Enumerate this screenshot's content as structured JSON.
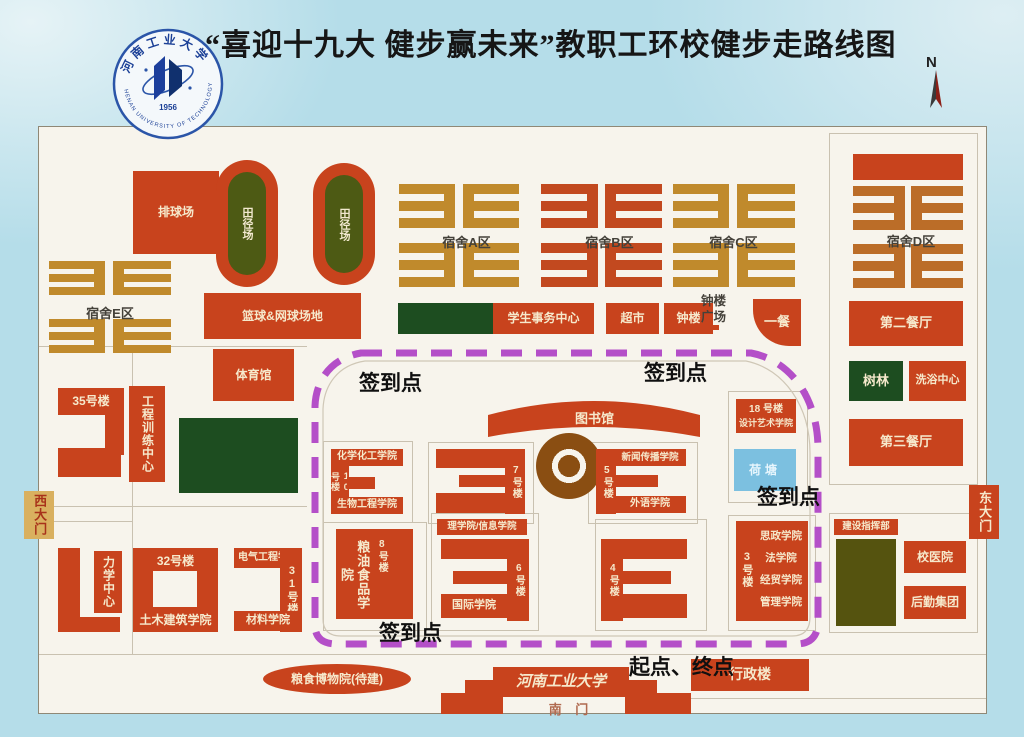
{
  "title": "“喜迎十九大 健步赢未来”教职工环校健步走路线图",
  "logo": {
    "name_cn": "河南工业大学",
    "name_en": "HENAN UNIVERSITY OF TECHNOLOGY",
    "year": "1956"
  },
  "compass": {
    "north": "N"
  },
  "colors": {
    "background": "#b5dde9",
    "paper": "#f7f4ec",
    "building": "#c8431d",
    "dorm_gold": "#c08a2c",
    "dorm_red": "#c2491f",
    "dark_green": "#1d4d20",
    "olive_green": "#55530f",
    "pond_blue": "#7cc0e0",
    "route": "#b44fc8"
  },
  "route": {
    "checkpoint": "签到点",
    "start_end": "起点、终点"
  },
  "labels": {
    "paiqiu": "排球场",
    "tianjing": "田径场",
    "lanqiu": "篮球&网球场地",
    "tiyuguan": "体育馆",
    "sushe_a": "宿舍A区",
    "sushe_b": "宿舍B区",
    "sushe_c": "宿舍C区",
    "sushe_d": "宿舍D区",
    "sushe_e": "宿舍E区",
    "xuesheng": "学生事务中心",
    "chaoshi": "超市",
    "zhonglou": "钟楼",
    "zhonglou_gc": "钟楼广场",
    "yican": "一餐",
    "lou35": "35号楼",
    "gongxun": "工程训练中心",
    "ximen": "西大门",
    "dongmen": "东大门",
    "lixue": "力学中心",
    "lou32": "32号楼",
    "tumu": "土木建筑学院",
    "dianqi": "电气工程学院",
    "lou31": "31号楼",
    "cailiao": "材料学院",
    "tushuguan": "图书馆",
    "huaxue": "化学化工学院",
    "lou10": "10号楼",
    "shengwu": "生物工程学院",
    "lou7": "7号楼",
    "xinwen": "新闻传播学院",
    "lou5": "5号楼",
    "waiyu": "外语学院",
    "lixin": "理学院/信息学院",
    "lou6": "6号楼",
    "guoji": "国际学院",
    "lou8": "8号楼",
    "liangyou": "粮油食品学院",
    "lou4": "4号楼",
    "lou3": "3号楼",
    "sizheng": "思政学院",
    "faxue": "法学院",
    "jingmao": "经贸学院",
    "guanli": "管理学院",
    "lou18": "18 号楼",
    "sheji": "设计艺术学院",
    "hetang": "荷塘",
    "dier": "第二餐厅",
    "shulin": "树林",
    "xiyu": "洗浴中心",
    "disan": "第三餐厅",
    "jianzhi": "建设指挥部",
    "xiaoyy": "校医院",
    "houqin": "后勤集团",
    "liangbo": "粮食博物院(待建)",
    "damen": "河南工业大学",
    "nanmen": "南 门",
    "xingzheng": "行政楼"
  }
}
